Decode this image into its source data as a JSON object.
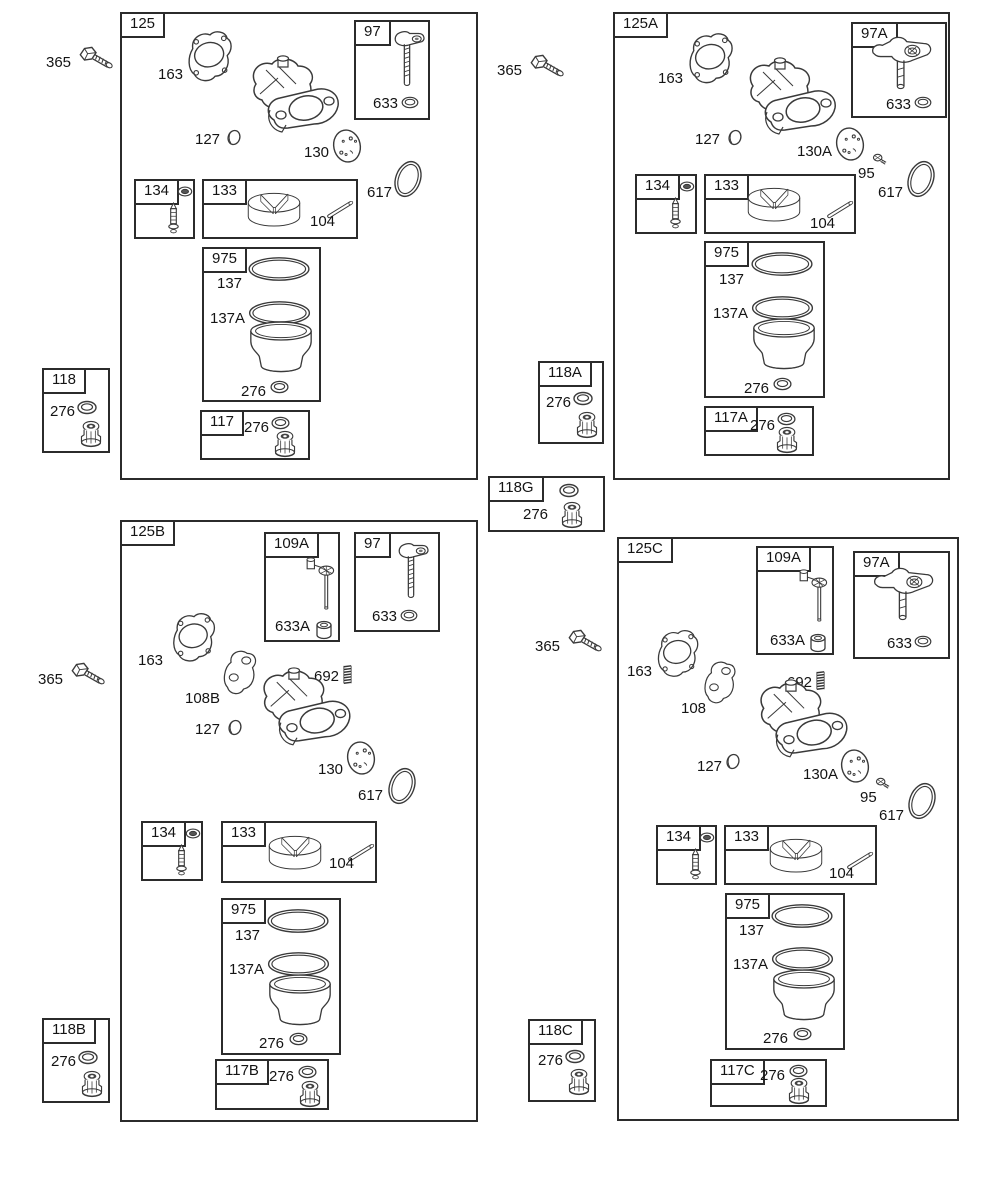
{
  "colors": {
    "line": "#2b2b2b",
    "part_line": "#3a3a3a",
    "background": "#ffffff"
  },
  "groups": {
    "g125": {
      "title": "125",
      "gasket": "163",
      "seal": "127",
      "plate": "130",
      "oring": "617",
      "box97": {
        "title": "97",
        "washer": "633"
      },
      "box134": {
        "title": "134"
      },
      "box133": {
        "title": "133",
        "pin": "104"
      },
      "box975": {
        "title": "975",
        "ring_upper": "137",
        "ring_lower": "137A",
        "washer": "276"
      },
      "box117": {
        "title": "117",
        "washer": "276"
      }
    },
    "g125A": {
      "title": "125A",
      "gasket": "163",
      "seal": "127",
      "plate": "130A",
      "screw": "95",
      "oring": "617",
      "box97A": {
        "title": "97A",
        "washer": "633"
      },
      "box134": {
        "title": "134"
      },
      "box133": {
        "title": "133",
        "pin": "104"
      },
      "box975": {
        "title": "975",
        "ring_upper": "137",
        "ring_lower": "137A",
        "washer": "276"
      },
      "box117A": {
        "title": "117A",
        "washer": "276"
      }
    },
    "g125B": {
      "title": "125B",
      "gasket": "163",
      "spacer": "108B",
      "spring": "692",
      "seal": "127",
      "plate": "130",
      "oring": "617",
      "box109A": {
        "title": "109A",
        "bushing": "633A"
      },
      "box97": {
        "title": "97",
        "washer": "633"
      },
      "box134": {
        "title": "134"
      },
      "box133": {
        "title": "133",
        "pin": "104"
      },
      "box975": {
        "title": "975",
        "ring_upper": "137",
        "ring_lower": "137A",
        "washer": "276"
      },
      "box117B": {
        "title": "117B",
        "washer": "276"
      }
    },
    "g125C": {
      "title": "125C",
      "gasket": "163",
      "spacer": "108",
      "spring": "692",
      "seal": "127",
      "plate": "130A",
      "screw": "95",
      "oring": "617",
      "box109A": {
        "title": "109A",
        "bushing": "633A"
      },
      "box97A": {
        "title": "97A",
        "washer": "633"
      },
      "box134": {
        "title": "134"
      },
      "box133": {
        "title": "133",
        "pin": "104"
      },
      "box975": {
        "title": "975",
        "ring_upper": "137",
        "ring_lower": "137A",
        "washer": "276"
      },
      "box117C": {
        "title": "117C",
        "washer": "276"
      }
    }
  },
  "loose": {
    "bolt_top_left": {
      "label": "365"
    },
    "bolt_top_mid": {
      "label": "365"
    },
    "bolt_mid_left": {
      "label": "365"
    },
    "bolt_mid_center": {
      "label": "365"
    },
    "kit118": {
      "title": "118",
      "washer": "276"
    },
    "kit118A": {
      "title": "118A",
      "washer": "276"
    },
    "kit118G": {
      "title": "118G",
      "washer": "276"
    },
    "kit118B": {
      "title": "118B",
      "washer": "276"
    },
    "kit118C": {
      "title": "118C",
      "washer": "276"
    }
  }
}
